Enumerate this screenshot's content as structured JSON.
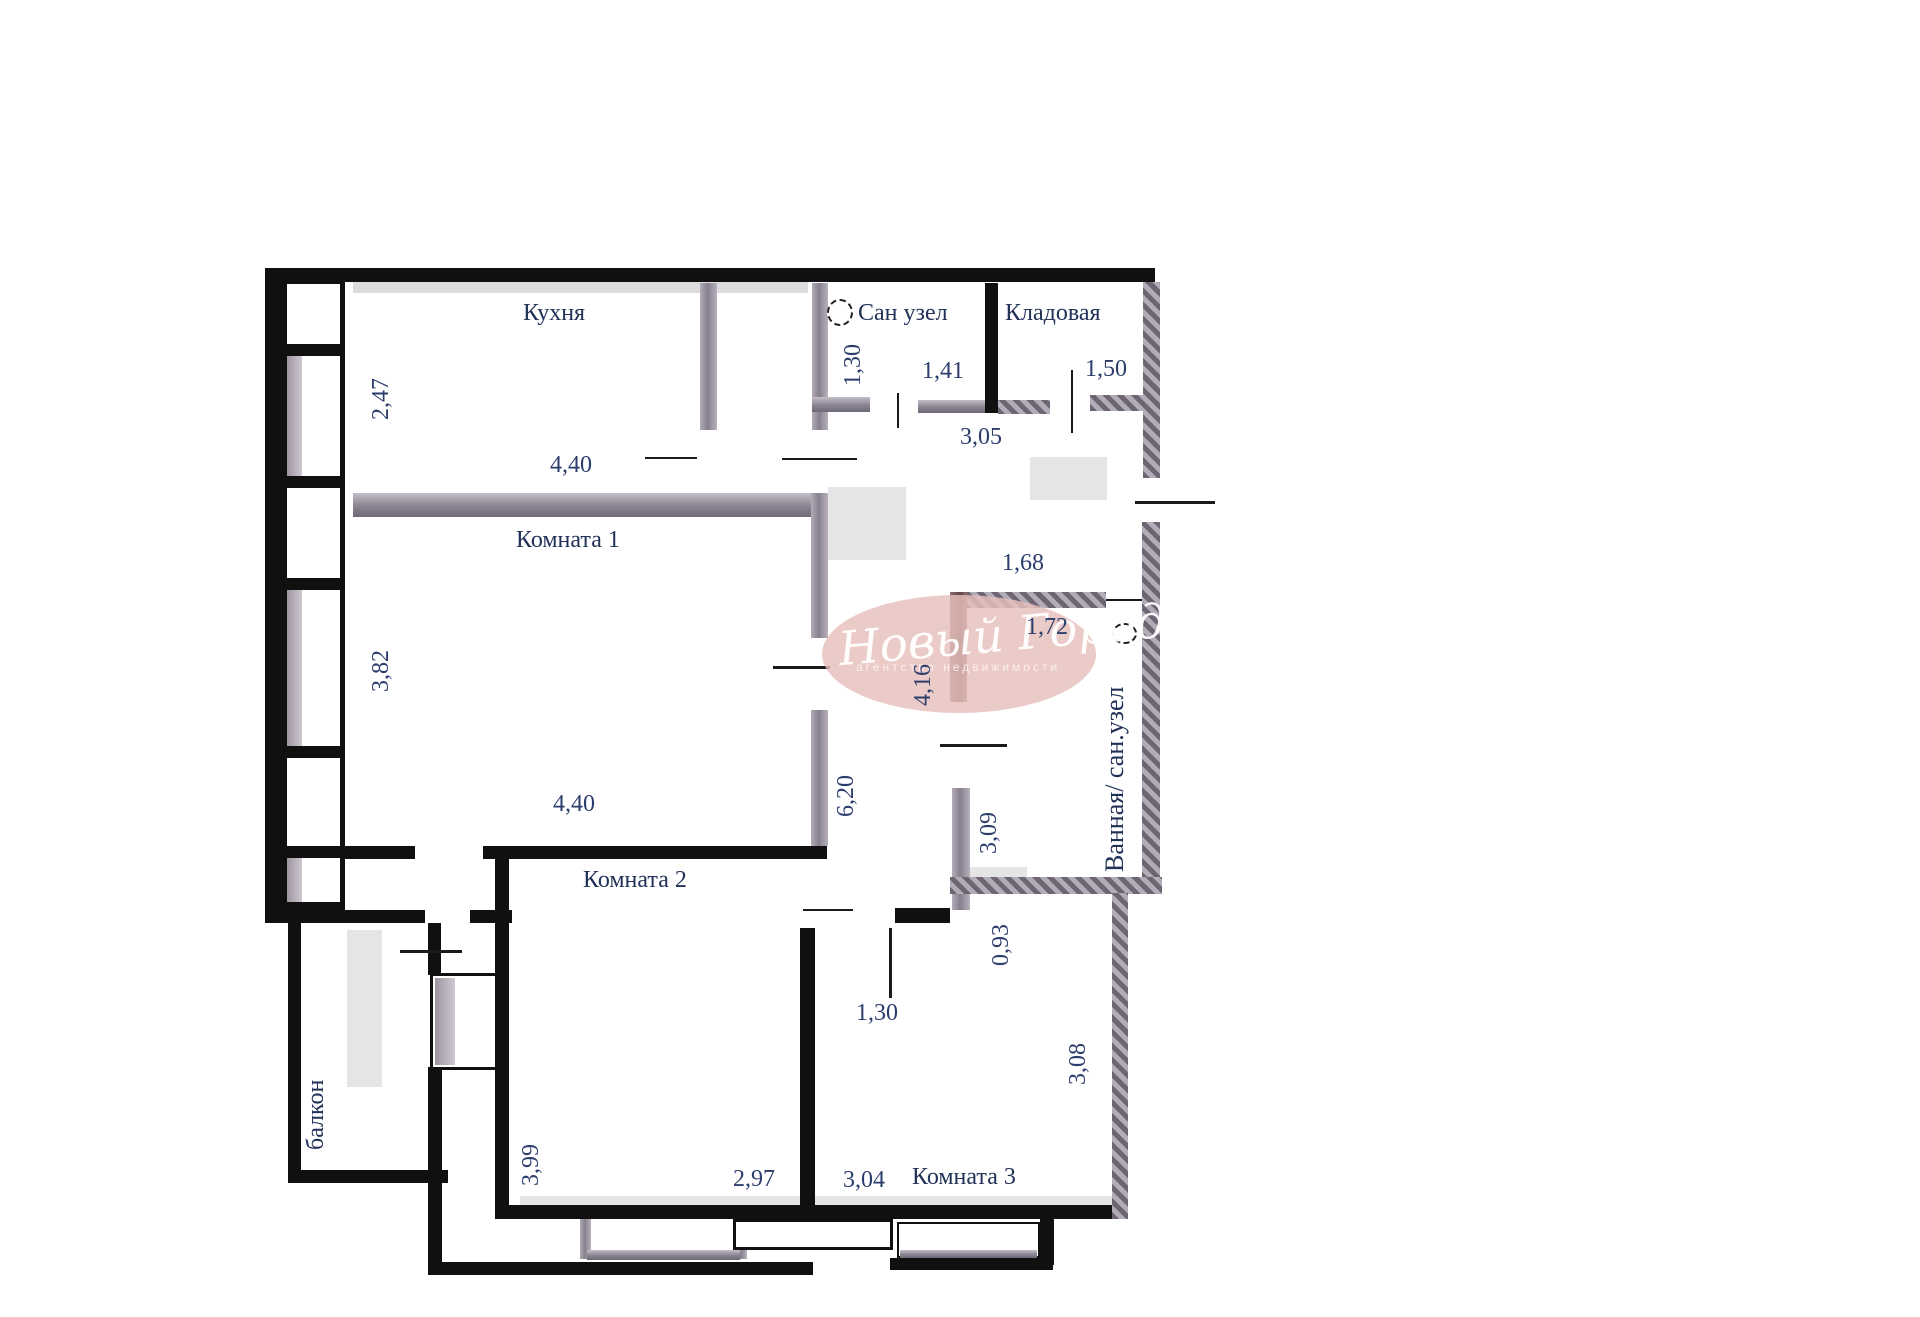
{
  "rooms": {
    "kitchen": "Кухня",
    "san_uzel": "Сан узел",
    "kladovaya": "Кладовая",
    "room1": "Комната 1",
    "room2": "Комната 2",
    "room3": "Комната 3",
    "bathroom": "Ванная/ сан.узел",
    "balcony": "балкон"
  },
  "dimensions": {
    "kitchen_depth": "2,47",
    "kitchen_width": "4,40",
    "san_uzel_depth": "1,30",
    "san_uzel_width": "1,41",
    "kladovaya_width": "1,50",
    "hallway_width": "3,05",
    "room1_depth": "3,82",
    "room1_width": "4,40",
    "entry_width": "1,68",
    "bathroom_width": "1,72",
    "hall_length_upper": "4,16",
    "corridor_length": "6,20",
    "bathroom_depth": "3,09",
    "niche_depth": "0,93",
    "room3_door_width": "1,30",
    "room3_depth": "3,08",
    "room2_depth": "3,99",
    "room2_width": "2,97",
    "room3_width": "3,04"
  },
  "watermark": {
    "title": "Новый Город",
    "subtitle": "агентство недвижимости"
  },
  "colors": {
    "bearing_wall": "#101010",
    "partition_wall": "#8a8391",
    "bathroom_wall": "#6b5252",
    "label_text": "#223158",
    "dimension_text": "#2c3d6d",
    "watermark_fill": "#e6c0bc"
  }
}
